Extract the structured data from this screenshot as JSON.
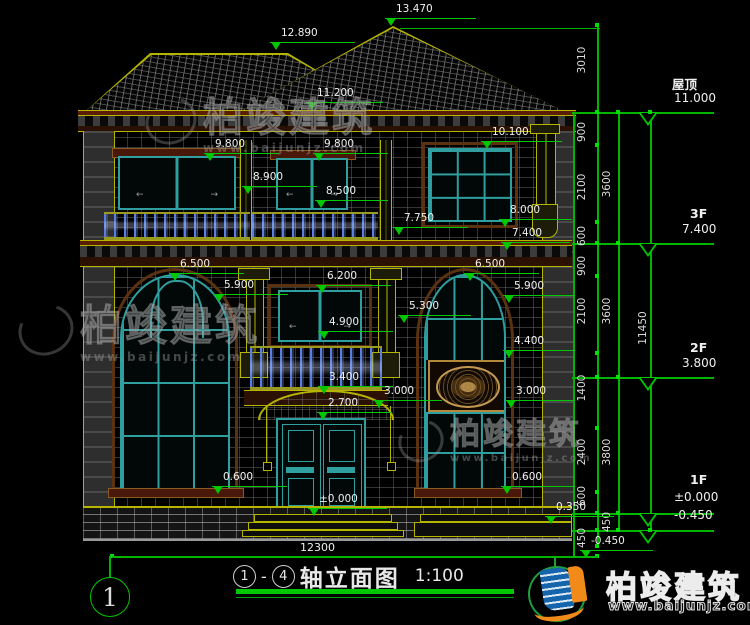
{
  "drawing": {
    "type": "建筑立面图",
    "overall_width_dim": "12300"
  },
  "title": {
    "axis_start": "1",
    "dash": "-",
    "axis_end": "4",
    "text": "轴立面图",
    "scale": "1:100"
  },
  "axis_bubble": {
    "label": "1"
  },
  "levels": [
    {
      "name": "屋顶",
      "value": "11.000"
    },
    {
      "name": "3F",
      "value": "7.400"
    },
    {
      "name": "2F",
      "value": "3.800"
    },
    {
      "name": "1F",
      "value": "±0.000"
    },
    {
      "name": "",
      "value": "-0.450"
    }
  ],
  "markers": [
    {
      "value": "13.470"
    },
    {
      "value": "12.890"
    },
    {
      "value": "11.200"
    },
    {
      "value": "9.800"
    },
    {
      "value": "9.800"
    },
    {
      "value": "8.900"
    },
    {
      "value": "8.500"
    },
    {
      "value": "10.100"
    },
    {
      "value": "8.000"
    },
    {
      "value": "7.400"
    },
    {
      "value": "7.750"
    },
    {
      "value": "6.500"
    },
    {
      "value": "5.900"
    },
    {
      "value": "6.200"
    },
    {
      "value": "5.300"
    },
    {
      "value": "4.900"
    },
    {
      "value": "6.500"
    },
    {
      "value": "5.900"
    },
    {
      "value": "4.400"
    },
    {
      "value": "3.400"
    },
    {
      "value": "3.000"
    },
    {
      "value": "3.000"
    },
    {
      "value": "2.700"
    },
    {
      "value": "±0.000"
    },
    {
      "value": "0.600"
    },
    {
      "value": "0.600"
    },
    {
      "value": "0.350"
    },
    {
      "value": "-0.450"
    }
  ],
  "dims": {
    "overall": "12300",
    "right_inner": [
      "3010",
      "900",
      "2100",
      "600",
      "900",
      "2100",
      "1400",
      "2400",
      "600",
      "450"
    ],
    "right_floors": [
      "3600",
      "3600",
      "3800",
      "450"
    ],
    "right_total": "11450"
  },
  "brand": {
    "name": "柏竣建筑",
    "url": "www.baijunjz.com"
  },
  "icons": {
    "slide_arrow_left": "←",
    "slide_arrow_right": "→"
  },
  "colors": {
    "dim_green": "#00c800",
    "trim_yellow": "#b5b500",
    "frame_teal": "#2f9e9e",
    "baluster_blue": "#5a7ede",
    "logo_blue": "#1565ad",
    "logo_orange": "#f28a1a",
    "logo_green": "#1e9e3e"
  }
}
